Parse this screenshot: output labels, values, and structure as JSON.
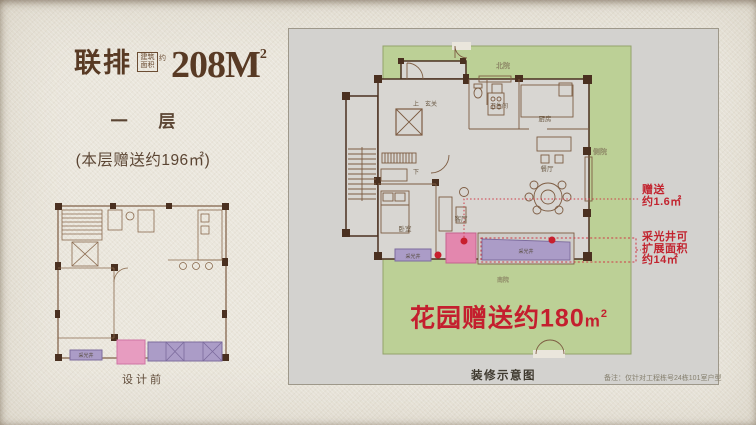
{
  "header": {
    "series": "联排",
    "area_box_label": "建筑面积",
    "approx_label": "约",
    "area_value": "208M",
    "area_sup": "2",
    "floor_label": "一 层",
    "floor_gift": "(本层赠送约196㎡)",
    "before_caption": "设计前"
  },
  "plan": {
    "rooms": {
      "north_yard": "北院",
      "side_yard": "侧院",
      "south_yard": "南院",
      "up": "上",
      "down": "下",
      "entry": "玄关",
      "bathroom": "卫生间",
      "kitchen": "厨房",
      "dining": "餐厅",
      "living": "客厅",
      "bedroom": "卧室",
      "lightwell": "采光井"
    },
    "annotations": {
      "gift_line1": "赠送",
      "gift_line2": "约1.6㎡",
      "well_line1": "采光井可",
      "well_line2": "扩展面积",
      "well_line3": "约14㎡",
      "garden_gift": "花园赠送约180",
      "garden_unit": "m",
      "garden_sup": "2",
      "caption": "装修示意图",
      "note": "备注：仅针对工程栋号24栋101室户型"
    }
  },
  "colors": {
    "accent_red": "#c41f2e",
    "garden_green": "#bcd096",
    "lightwell_purple": "#ab9cc7",
    "gift_pink": "#e387ae",
    "title_brown": "#583a24",
    "panel_gray": "#d3d2cf"
  }
}
